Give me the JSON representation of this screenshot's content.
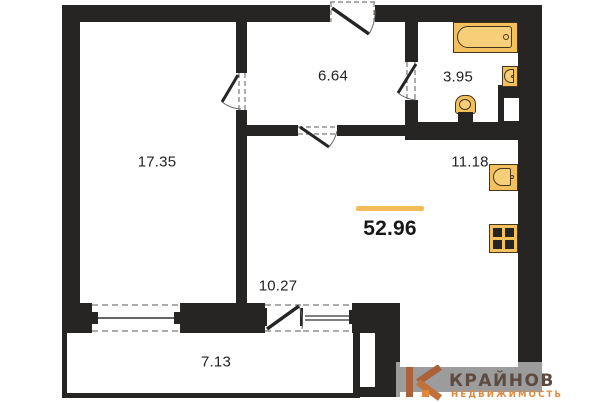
{
  "plan": {
    "total_area_label": "52.96",
    "rooms": [
      {
        "name": "room",
        "area": "17.35"
      },
      {
        "name": "hallway",
        "area": "6.64"
      },
      {
        "name": "bathroom",
        "area": "3.95"
      },
      {
        "name": "kitchen",
        "area": "11.18"
      },
      {
        "name": "living-zone",
        "area": "10.27"
      },
      {
        "name": "balcony",
        "area": "7.13"
      }
    ],
    "fixtures": [
      "bathtub",
      "bathroom-sink",
      "toilet",
      "kitchen-sink",
      "stove"
    ],
    "colors": {
      "wall": "#262524",
      "fixture": "#f2c05c",
      "fixture-light": "#f7cf78",
      "fixture-border": "#46341d",
      "accent": "#f2bd59",
      "logo-mark": "#ab6139",
      "logo-mark-light": "#c0713c",
      "logo-dot": "#e0873c",
      "logo-text": "#5d4b41",
      "logo-subtext": "#e2873c"
    }
  },
  "logo": {
    "brand": "КРАЙНОВ",
    "subtitle": "НЕДВИЖИМОСТЬ"
  }
}
